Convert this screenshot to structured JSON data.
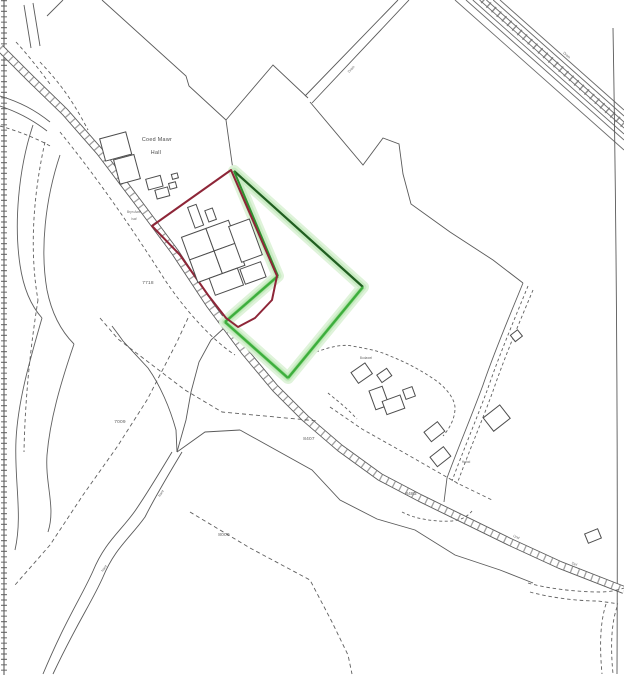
{
  "map": {
    "type": "scanned-site-plan",
    "palette": {
      "background": "#ffffff",
      "line": "#4d4d4d",
      "line_light": "#6f6f6f",
      "red_boundary": "#8e2638",
      "green_dark": "#215e21",
      "green_bright": "#3dae3d",
      "green_glow": "#c8ebc2"
    },
    "labels": {
      "hall": {
        "line1": "Coed Mawr",
        "line2": "Hall"
      },
      "farm": {
        "line1": "Bryn Awel",
        "line2": "Isaf"
      },
      "houses": [
        {
          "text": "Bodawel"
        },
        {
          "text": "Hafod"
        }
      ],
      "parcels": [
        {
          "text": "7718"
        },
        {
          "text": "7009"
        },
        {
          "text": "8407"
        },
        {
          "text": "8000"
        },
        {
          "text": "8483"
        }
      ],
      "micro": [
        {
          "text": "Drain"
        },
        {
          "text": "Drain"
        },
        {
          "text": "Und"
        },
        {
          "text": "Def"
        },
        {
          "text": "Nant"
        },
        {
          "text": "Nant"
        }
      ]
    }
  }
}
